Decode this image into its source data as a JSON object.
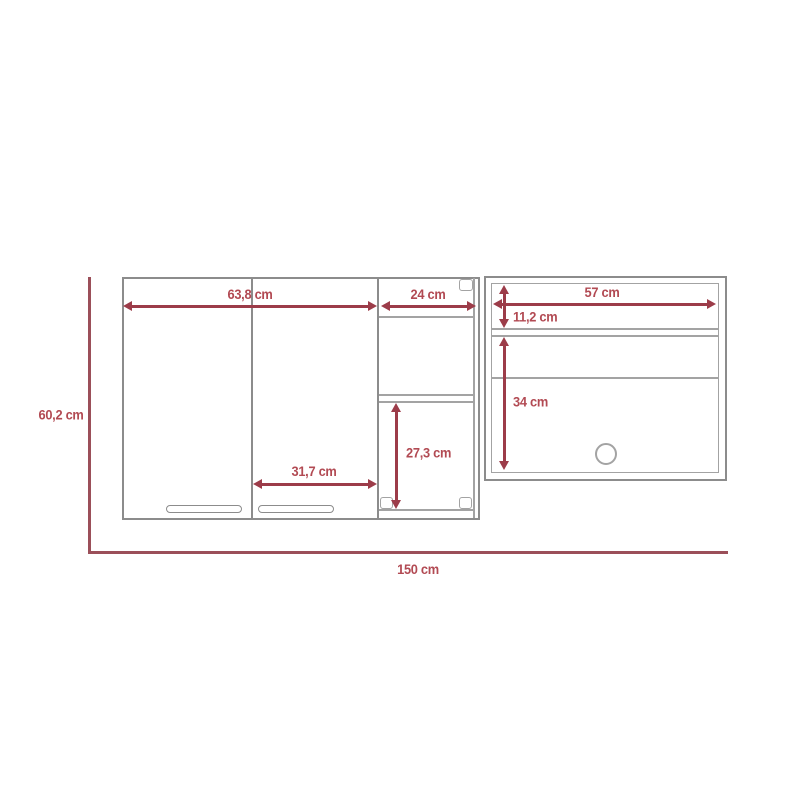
{
  "diagram": {
    "subject": "wall-cabinet-dimension-diagram",
    "unit": "cm",
    "labels": {
      "doors_width": "63,8 cm",
      "open_width": "24 cm",
      "right_width": "57 cm",
      "right_top_gap": "11,2 cm",
      "right_open_height": "34 cm",
      "open_lower_height": "27,3 cm",
      "single_door_width": "31,7 cm",
      "total_height": "60,2 cm",
      "total_width": "150 cm"
    },
    "measurements_cm": {
      "doors_width": 63.8,
      "open_width": 24,
      "right_width": 57,
      "right_top_gap": 11.2,
      "right_open_height": 34,
      "open_lower_height": 27.3,
      "single_door_width": 31.7,
      "total_height": 60.2,
      "total_width": 150
    },
    "colors": {
      "dimension_line": "#9c3c49",
      "dimension_text": "#b24a53",
      "overall_line": "#9b4f59",
      "cabinet_outline": "#8c8c8c",
      "cabinet_inner": "#a3a3a3",
      "background": "#ffffff"
    }
  }
}
